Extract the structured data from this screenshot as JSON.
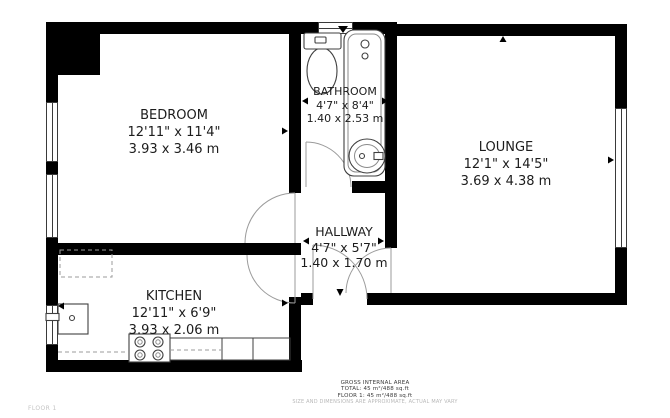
{
  "floorplan": {
    "rooms": [
      {
        "name": "BEDROOM",
        "imperial": "12'11\" x 11'4\"",
        "metric": "3.93 x 3.46 m"
      },
      {
        "name": "BATHROOM",
        "imperial": "4'7\" x 8'4\"",
        "metric": "1.40 x 2.53 m"
      },
      {
        "name": "LOUNGE",
        "imperial": "12'1\" x 14'5\"",
        "metric": "3.69 x 4.38 m"
      },
      {
        "name": "HALLWAY",
        "imperial": "4'7\" x 5'7\"",
        "metric": "1.40 x 1.70 m"
      },
      {
        "name": "KITCHEN",
        "imperial": "12'11\" x 6'9\"",
        "metric": "3.93 x 2.06 m"
      }
    ],
    "footer": {
      "area_title": "GROSS INTERNAL AREA",
      "total": "TOTAL: 45 m²/488 sq.ft",
      "floor1": "FLOOR 1: 45 m²/488 sq.ft",
      "disclaimer": "SIZE AND DIMENSIONS ARE APPROXIMATE, ACTUAL MAY VARY"
    },
    "floor_label": "FLOOR 1",
    "colors": {
      "wall": "#000000",
      "line": "#9b9b9b",
      "text": "#1c1c1c",
      "muted": "#c4c4c4"
    }
  }
}
